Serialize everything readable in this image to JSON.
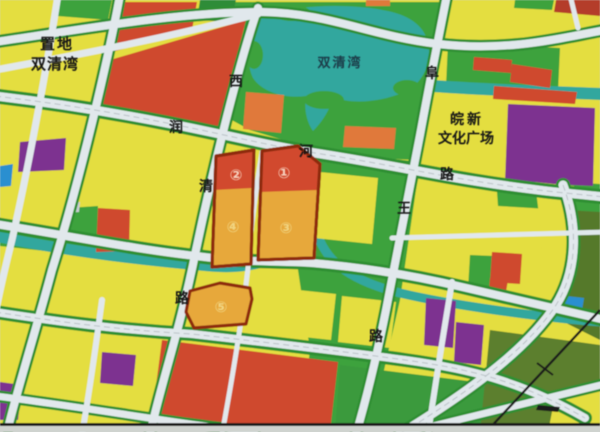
{
  "map": {
    "title_hint": "urban planning parcel map photo",
    "labels": {
      "zhidi_line1": "置地",
      "zhidi_line2": "双清湾",
      "lake": "双清湾",
      "wanxin_line1": "皖新",
      "wanxin_line2": "文化广场"
    },
    "roads": {
      "runhe": [
        "润",
        "河",
        "路"
      ],
      "west": [
        "西",
        "清",
        "路"
      ],
      "fuwang": [
        "阜",
        "王",
        "路"
      ]
    },
    "lots": [
      "①",
      "②",
      "③",
      "④",
      "⑤"
    ],
    "palette": {
      "parcel_yellow": "#e4de3f",
      "parcel_red": "#cf4a2e",
      "parcel_orange_lot": "#e7a83a",
      "lot_outline_maroon": "#8e2c10",
      "park_green": "#3da23e",
      "dark_olive_green": "#5b7f2e",
      "lake_teal": "#31a79e",
      "purple": "#7d3190",
      "blue": "#2a8fd0",
      "road_white": "#e1e8ec",
      "shore_orange": "#e0793a"
    }
  }
}
